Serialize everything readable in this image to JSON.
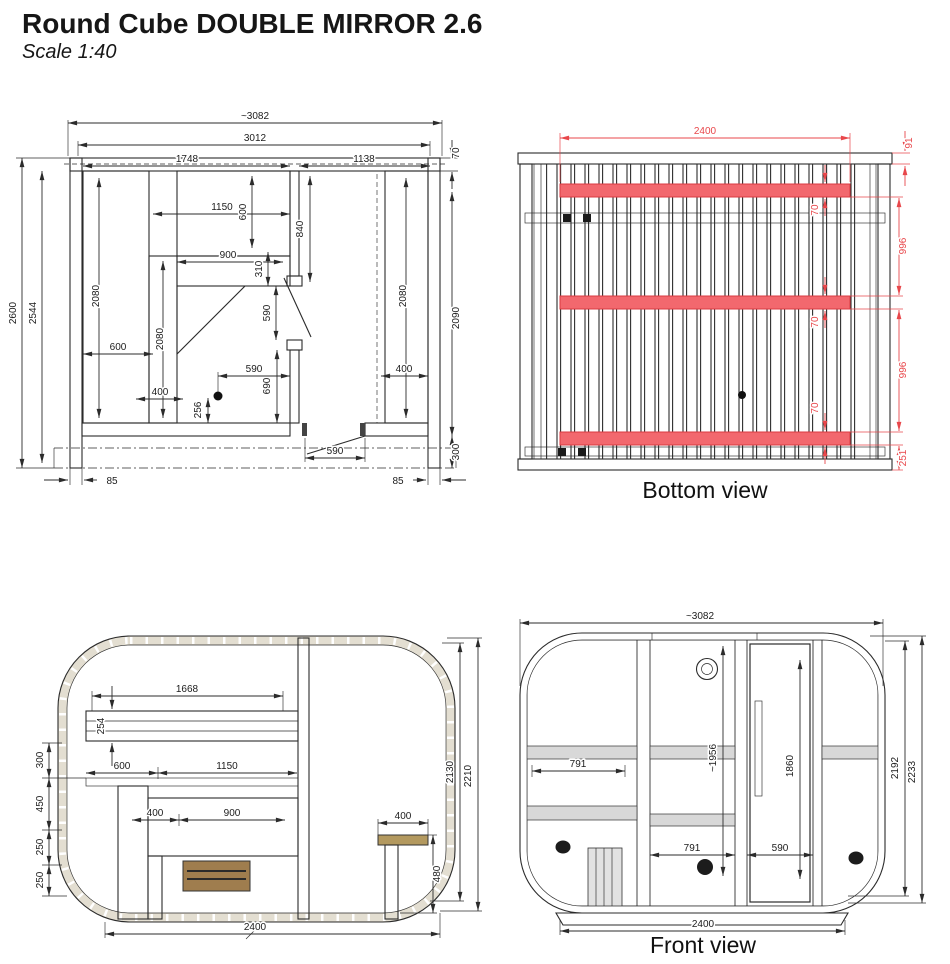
{
  "title": "Round Cube DOUBLE MIRROR 2.6",
  "subtitle": "Scale 1:40",
  "colors": {
    "accent_red": "#e8474b",
    "beam_fill": "#f2686e",
    "line": "#2b2b2b",
    "wood_light": "#e9e3d0",
    "wood_tan": "#d8cca9",
    "wood_dark": "#b49c6e",
    "heater_wood": "#9f7d4e"
  },
  "views": {
    "plan": {
      "dims": {
        "overall_width": "~3082",
        "frame_width": "3012",
        "sauna_width": "1748",
        "room_width": "1138",
        "roof_offset": "70",
        "overall_height": "2600",
        "inner_height": "2544",
        "right_height": "2090",
        "bench_left_len": "2080",
        "bench_mid_len": "2080",
        "bench_right_len": "2080",
        "top_bench_width": "1150",
        "top_bench_depth": "600",
        "wall_to_door": "840",
        "mid_bench_width": "900",
        "mid_bench_depth": "310",
        "door_opening": "590",
        "bench_left_width": "600",
        "bench_step_width": "400",
        "heater_offset": "256",
        "heater_to_wall": "590",
        "door_to_sill": "690",
        "bench_right_width": "400",
        "front_door_width": "590",
        "base_front": "300",
        "base_left": "85",
        "base_right": "85"
      }
    },
    "bottom": {
      "label": "Bottom view",
      "dims": {
        "beam_span": "2400",
        "edge_offset": "91",
        "beam1_width": "70",
        "beam2_width": "70",
        "beam3_width": "70",
        "beam_pitch_1": "996",
        "beam_pitch_2": "996",
        "beam_end_offset": "251"
      }
    },
    "side": {
      "dims": {
        "top_bench_length": "1668",
        "top_bench_thickness": "254",
        "bench_width": "600",
        "platform_width": "1150",
        "backrest_height": "300",
        "tier_height": "450",
        "step_height_1": "250",
        "step_height_2": "250",
        "seat_depth": "400",
        "platform_depth": "900",
        "room_bench_width": "400",
        "room_bench_height": "480",
        "inner_height": "2130",
        "outer_height": "2210",
        "base_length": "2400"
      }
    },
    "front": {
      "label": "Front view",
      "dims": {
        "overall_width": "~3082",
        "window_left_width": "791",
        "glass_height": "~1956",
        "door_height": "1860",
        "window_center_width": "791",
        "door_width": "590",
        "inner_height": "2192",
        "outer_height": "2233",
        "base_length": "2400"
      }
    }
  }
}
